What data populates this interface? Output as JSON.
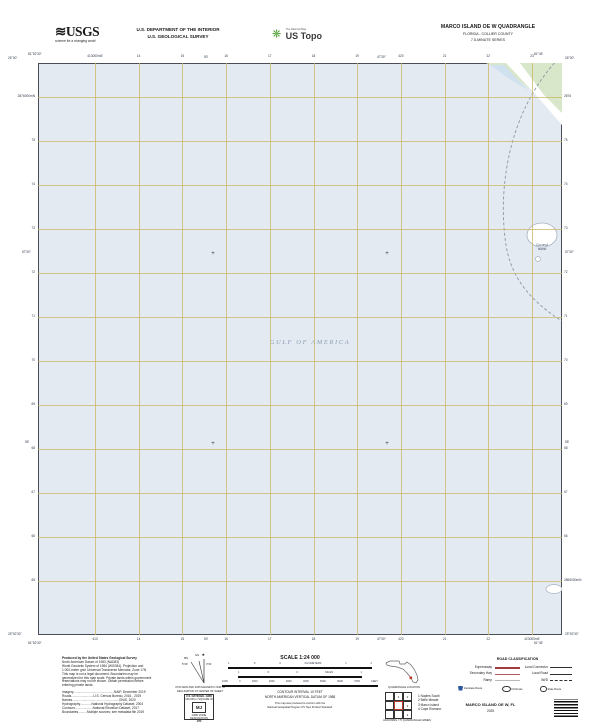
{
  "header": {
    "usgs_logo": "USGS",
    "usgs_tagline": "science for a changing world",
    "dept_line1": "U.S. DEPARTMENT OF THE INTERIOR",
    "dept_line2": "U.S. GEOLOGICAL SURVEY",
    "ustopo_tagline": "The National Map",
    "ustopo_brand": "US Topo",
    "quad_title": "MARCO ISLAND OE W QUADRANGLE",
    "quad_subtitle1": "FLORIDA - COLLIER COUNTY",
    "quad_subtitle2": "7.5-MINUTE SERIES"
  },
  "map": {
    "water_label": "GULF OF AMERICA",
    "island_label_line1": "Coconut",
    "island_label_line2": "Island",
    "top_eastings": [
      "413000mE",
      "14",
      "15",
      "16",
      "17",
      "18",
      "19",
      "420",
      "21",
      "22",
      "23"
    ],
    "bottom_eastings": [
      "413",
      "14",
      "15",
      "16",
      "17",
      "18",
      "19",
      "420",
      "21",
      "22",
      "423000mE"
    ],
    "left_northings": [
      "2876000mN",
      "75",
      "74",
      "73",
      "72",
      "71",
      "70",
      "69",
      "68",
      "67",
      "66",
      "65"
    ],
    "right_northings": [
      "2876",
      "75",
      "74",
      "73",
      "72",
      "71",
      "70",
      "69",
      "68",
      "67",
      "66",
      "2865000mN"
    ],
    "corners": {
      "top_left_lat": "26°00'",
      "top_left_lon": "81°52'30\"",
      "top_right_lon": "81°45'",
      "top_right_lat": "26°00'",
      "bottom_left_lat": "25°52'30\"",
      "bottom_left_lon": "81°52'30\"",
      "bottom_right_lon": "81°45'",
      "bottom_right_lat": "25°52'30\""
    },
    "minute_labels": {
      "top": [
        "50'",
        "47'30\""
      ],
      "left": [
        "57'30\"",
        "55'"
      ],
      "bottom": [
        "50'",
        "47'30\""
      ],
      "right": [
        "57'30\"",
        "55'"
      ]
    },
    "colors": {
      "water": "#e3eaf2",
      "grid": "#cab660",
      "land": "#d8e6c9",
      "water_label": "#8d9db5"
    }
  },
  "footer": {
    "produced_by": [
      "Produced by the United States Geological Survey",
      "North American Datum of 1983 (NAD83)",
      "World Geodetic System of 1984 (WGS84). Projection and",
      "1 000-meter grid: Universal Transverse Mercator, Zone 17N",
      "This map is not a legal document. Boundaries may be",
      "generalized for this map scale. Private lands within government",
      "reservations may not be shown. Obtain permission before",
      "entering private lands.",
      "Imagery..............................................NAIP, December 2019",
      "Roads.........................U.S. Census Bureau, 2016 - 2019",
      "Names.....................................................GNIS, 2020",
      "Hydrography.............National Hydrography Dataset, 2004",
      "Contours....................National Elevation Dataset, 2017",
      "Boundaries..........Multiple sources; see metadata file 2019"
    ],
    "declination": {
      "star": "★",
      "gn_label": "GN",
      "mn_label": "MN",
      "gn_value": "0°21'",
      "mn_value": "5°29'",
      "caption1": "UTM GRID AND 2025 MAGNETIC NORTH",
      "caption2": "DECLINATION AT CENTER OF SHEET"
    },
    "usng": {
      "title": "U.S. NATIONAL GRID",
      "subtitle": "100,000-m SQUARE ID",
      "square_id": "MJ",
      "zone_label": "GRID ZONE DESIGNATION",
      "zone": "17R"
    },
    "scale": {
      "title": "SCALE 1:24 000",
      "bars": [
        {
          "unit": "KILOMETERS",
          "ticks": [
            "1",
            ".5",
            "0",
            "KILOMETERS",
            "1",
            "2"
          ],
          "segments": 8
        },
        {
          "unit": "MILES",
          "ticks": [
            "1",
            ".5",
            "0",
            "MILES",
            "1"
          ],
          "segments": 6
        },
        {
          "unit": "FEET",
          "ticks": [
            "1000",
            "0",
            "1000",
            "2000",
            "3000",
            "4000",
            "5000",
            "6000",
            "7000",
            "FEET"
          ],
          "segments": 10
        }
      ]
    },
    "contour_note1": "CONTOUR INTERVAL 10 FEET",
    "contour_note2": "NORTH AMERICAN VERTICAL DATUM OF 1988",
    "standard_note1": "This map was produced to conform with the",
    "standard_note2": "National Geospatial Program US Topo Product Standard.",
    "florida": {
      "caption": "QUADRANGLE LOCATION"
    },
    "adjoining": {
      "caption": "ADJOINING 7.5' QUADRANGLE NAMES",
      "cells": [
        "",
        "1",
        "2",
        "",
        "",
        "3",
        "",
        "",
        "4"
      ],
      "names": [
        "1  Naples South",
        "2  Belle Meade",
        "3  Marco Island",
        "4  Cape Romano"
      ]
    },
    "road_class": {
      "title": "ROAD CLASSIFICATION",
      "left_rows": [
        {
          "label": "Expressway",
          "style": "expressway"
        },
        {
          "label": "Secondary Hwy",
          "style": "secondary"
        },
        {
          "label": "Ramp",
          "style": "ramp"
        }
      ],
      "right_rows": [
        {
          "label": "Local Connector",
          "style": "connector"
        },
        {
          "label": "Local Road",
          "style": "local"
        },
        {
          "label": "4WD",
          "style": "fourwd"
        }
      ],
      "shields": [
        {
          "label": "Interstate Route",
          "icon": "interstate-shield-icon"
        },
        {
          "label": "US Route",
          "icon": "us-route-shield-icon"
        },
        {
          "label": "State Route",
          "icon": "state-route-shield-icon"
        }
      ]
    },
    "imprint": {
      "map_name": "MARCO ISLAND OE W, FL",
      "year": "2025"
    }
  }
}
